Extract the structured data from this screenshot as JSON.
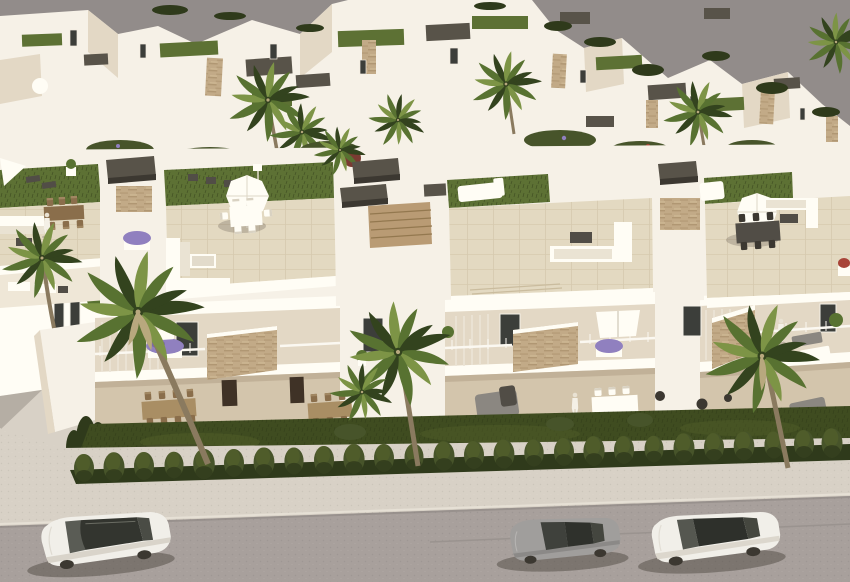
{
  "scene": {
    "type": "architectural-3d-render",
    "description": "Aerial 3D architectural rendering of a modern white residential development: flat-roofed townhouses with rooftop terraces furnished with sofas, dining sets, white parasols, sun loungers and artificial grass; stone-clad accent panels and purple flower boxes on the balconies; ground-floor terraces above a dark lawn with palm trees; a trimmed hedge, light sidewalk and a gray street with three parked cars in the foreground; flat gray sky behind a second row of white villas.",
    "people_visible": 3,
    "parasols_visible": 4,
    "cars": [
      {
        "position": "left",
        "type": "suv",
        "color_name": "white",
        "roof": "dark panoramic glass"
      },
      {
        "position": "center-right",
        "type": "coupe",
        "color_name": "silver"
      },
      {
        "position": "right",
        "type": "sedan",
        "color_name": "white",
        "roof": "dark panoramic glass"
      }
    ]
  },
  "colors": {
    "sky": "#928c8a",
    "building_white": "#f6f1e7",
    "building_bright": "#fffdf5",
    "cream": "#efe7d7",
    "wall_shade": "#e3d8c5",
    "wall_shade_deep": "#d3c5ac",
    "deep_shade": "#b5a48b",
    "terrace_tile": "#e3d9c1",
    "stone_clad": "#c2aa87",
    "stone_dark": "#a18762",
    "roof_cap": "#585349",
    "roof_cap_dark": "#3c3831",
    "roof_grass": "#5d7134",
    "lawn": "#3f4c20",
    "lawn_light": "#55622a",
    "hedge": "#47542a",
    "hedge_dark": "#2f3a1b",
    "palm": "#587231",
    "palm_dark": "#33431e",
    "palm_light": "#7d9446",
    "trunk": "#8a7a5f",
    "flower_purple": "#9080bf",
    "flower_red": "#a84438",
    "wood_furniture": "#8a6e4b",
    "wood_light": "#a98e64",
    "gray_furniture": "#8b8781",
    "dark_furniture": "#514d46",
    "glass": "#3c3e3a",
    "street": "#a8a09c",
    "sidewalk": "#d8d1c6",
    "car_white": "#f1efe9",
    "car_silver": "#a09e9c"
  }
}
